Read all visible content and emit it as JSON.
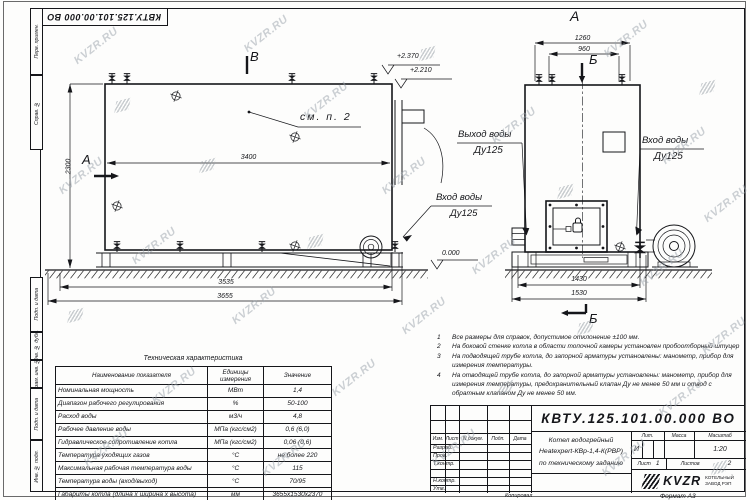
{
  "watermark": {
    "text": "KVZR.RU"
  },
  "stamp_top": "КВТУ.125.101.00.000  ВО",
  "margin_labels": [
    "Перв. примен.",
    "Справ. №",
    "Подп. и дата",
    "Инв. № дубл.",
    "Взам. инв. №",
    "Подп. и дата",
    "Инв. № подл."
  ],
  "views": {
    "side": {
      "section_a": "А",
      "section_b": "В",
      "callout": "см. п. 2",
      "dims": {
        "inner_length": "3400",
        "height": "2300",
        "base_length": "3535",
        "overall_length": "3655"
      },
      "elevations": {
        "top": "+2.370",
        "flue": "+2.210",
        "zero": "0.000"
      },
      "inlet_line1": "Вход воды",
      "inlet_line2": "Ду125"
    },
    "front": {
      "view_label": "А",
      "section_b": "Б",
      "dims": {
        "top_outer": "1260",
        "top_inner": "960",
        "base": "1430",
        "overall": "1530"
      },
      "outlet_line1": "Выход воды",
      "outlet_line2": "Ду125",
      "inlet_line1": "Вход воды",
      "inlet_line2": "Ду125"
    }
  },
  "notes": {
    "items": [
      {
        "num": "1",
        "text": "Все размеры для справок, допустимое отклонение ±100 мм."
      },
      {
        "num": "2",
        "text": "На боковой стенке котла в области топочной камеры установлен пробоотборный штуцер"
      },
      {
        "num": "3",
        "text": "На подводящей трубе котла, до запорной арматуры установлены: манометр, прибор для измерения температуры."
      },
      {
        "num": "4",
        "text": "На отводящей трубе котла, до запорной арматуры установлены: манометр, прибор для измерения температуры, предохранительный клапан Ду не менее 50 мм и отвод с обратным клапаном Ду не менее 50 мм."
      }
    ]
  },
  "tech_table": {
    "title": "Техническая характеристика",
    "headers": [
      "Наименование показателя",
      "Единицы измерения",
      "Значение"
    ],
    "rows": [
      [
        "Номинальная мощность",
        "МВт",
        "1,4"
      ],
      [
        "Диапазон рабочего регулирования",
        "%",
        "50-100"
      ],
      [
        "Расход воды",
        "м3/ч",
        "4,8"
      ],
      [
        "Рабочее давление воды",
        "МПа (кгс/см2)",
        "0,6 (6,0)"
      ],
      [
        "Гидравлическое сопротивление котла",
        "МПа (кгс/см2)",
        "0,06 (0,6)"
      ],
      [
        "Температура уходящих газов",
        "°С",
        "не более 220"
      ],
      [
        "Максимальная рабочая температура воды",
        "°С",
        "115"
      ],
      [
        "Температура воды (вход/выход)",
        "°С",
        "70/95"
      ],
      [
        "Габариты котла (длина х ширина х высота)",
        "мм",
        "3655х1530х2370"
      ]
    ]
  },
  "title_block": {
    "doc_number": "КВТУ.125.101.00.000  ВО",
    "header_cols": [
      "Изм.",
      "Лист",
      "N докум.",
      "Подп.",
      "Дата"
    ],
    "role_rows": [
      "Разраб.",
      "Пров.",
      "Т.контр.",
      "",
      "Н.контр.",
      "Утв."
    ],
    "name_line1": "Котел водогрейный",
    "name_line2": "Heatexpert-КВр-1,4-К(РВР)",
    "name_line3": "по техническому заданию",
    "lit_header": "Лит.",
    "mass_header": "Масса",
    "scale_header": "Масштаб",
    "lit_value": "И",
    "scale_value": "1:20",
    "sheet_label": "Лист",
    "sheet_value": "1",
    "sheets_label": "Листов",
    "sheets_value": "2",
    "brand": "KVZR",
    "brand_sub1": "КОТЕЛЬНЫЙ",
    "brand_sub2": "ЗАВОД РЭП",
    "copy_label": "Копировал",
    "format_label": "Формат  А3"
  }
}
